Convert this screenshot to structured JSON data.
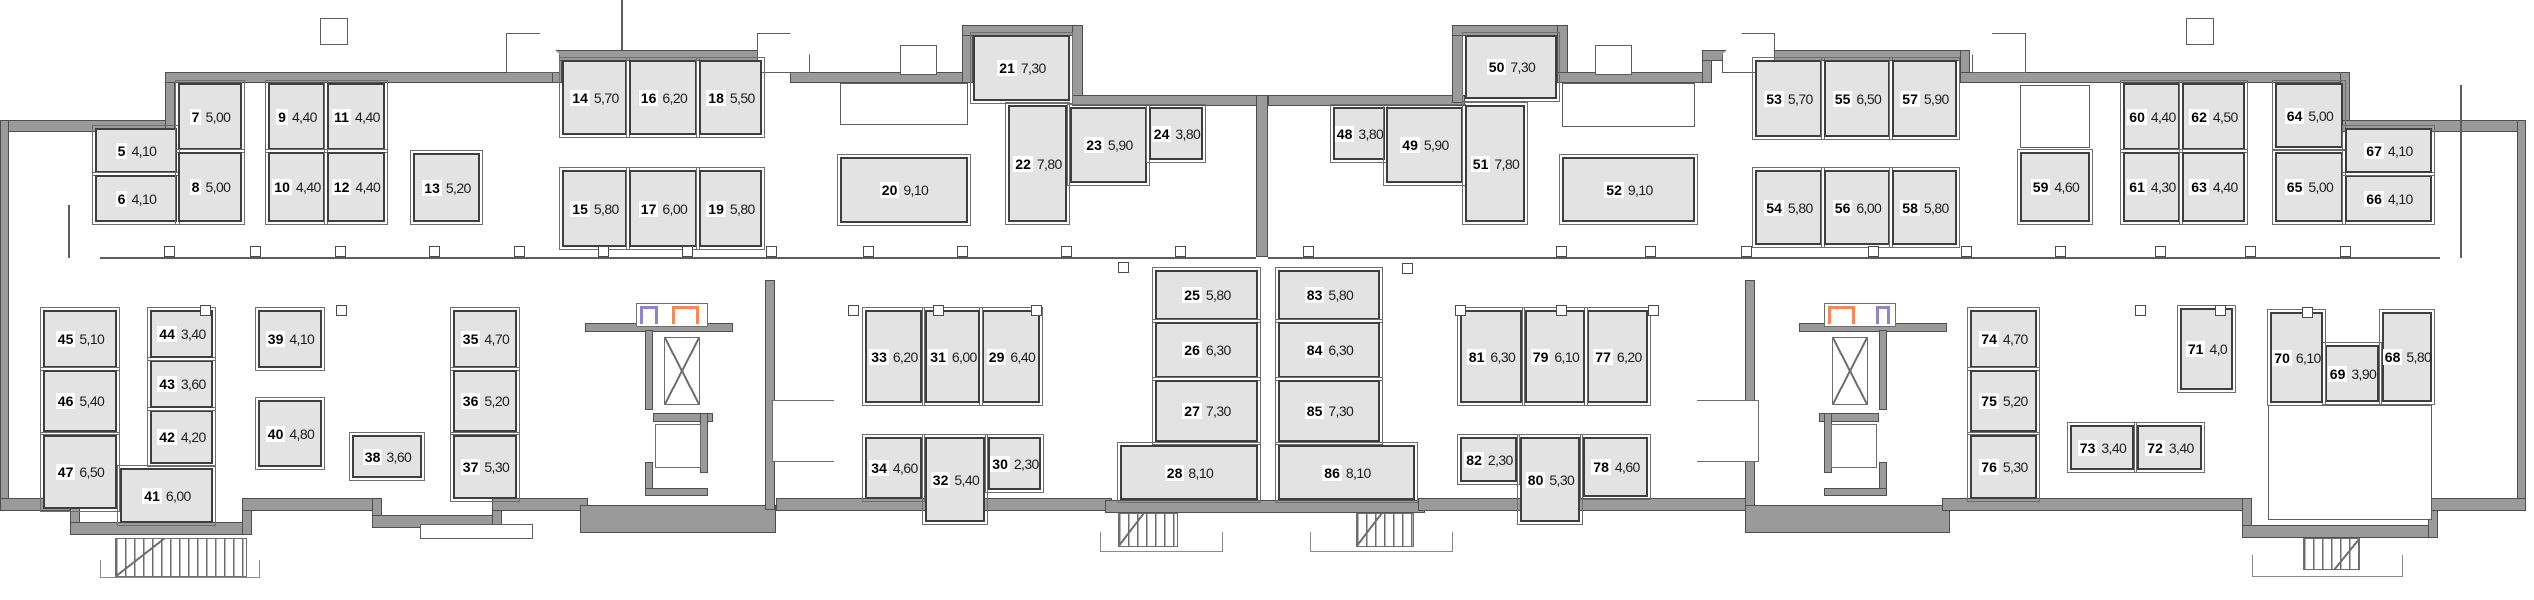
{
  "plan": {
    "canvas": {
      "w": 2534,
      "h": 600
    },
    "colors": {
      "wall_gray": "#9a9a9a",
      "wall_edge": "#4f4f4f",
      "room_fill": "#e3e3e3",
      "room_border": "#3e3e3e",
      "door_marker_purple": "#9185c6",
      "door_marker_orange": "#f08a5c",
      "background": "#ffffff"
    },
    "rooms": [
      {
        "n": "5",
        "a": "4,10",
        "x": 95,
        "y": 128,
        "w": 82,
        "h": 45
      },
      {
        "n": "6",
        "a": "4,10",
        "x": 95,
        "y": 175,
        "w": 82,
        "h": 47
      },
      {
        "n": "7",
        "a": "5,00",
        "x": 178,
        "y": 83,
        "w": 64,
        "h": 67
      },
      {
        "n": "8",
        "a": "5,00",
        "x": 178,
        "y": 152,
        "w": 64,
        "h": 70
      },
      {
        "n": "9",
        "a": "4,40",
        "x": 268,
        "y": 83,
        "w": 57,
        "h": 67
      },
      {
        "n": "10",
        "a": "4,40",
        "x": 268,
        "y": 152,
        "w": 57,
        "h": 70
      },
      {
        "n": "11",
        "a": "4,40",
        "x": 327,
        "y": 83,
        "w": 58,
        "h": 67
      },
      {
        "n": "12",
        "a": "4,40",
        "x": 327,
        "y": 152,
        "w": 58,
        "h": 70
      },
      {
        "n": "13",
        "a": "5,20",
        "x": 413,
        "y": 153,
        "w": 67,
        "h": 69
      },
      {
        "n": "14",
        "a": "5,70",
        "x": 562,
        "y": 60,
        "w": 65,
        "h": 75
      },
      {
        "n": "15",
        "a": "5,80",
        "x": 562,
        "y": 170,
        "w": 65,
        "h": 77
      },
      {
        "n": "16",
        "a": "6,20",
        "x": 629,
        "y": 60,
        "w": 68,
        "h": 75
      },
      {
        "n": "17",
        "a": "6,00",
        "x": 629,
        "y": 170,
        "w": 68,
        "h": 77
      },
      {
        "n": "18",
        "a": "5,50",
        "x": 699,
        "y": 60,
        "w": 63,
        "h": 75
      },
      {
        "n": "19",
        "a": "5,80",
        "x": 699,
        "y": 170,
        "w": 63,
        "h": 77
      },
      {
        "n": "20",
        "a": "9,10",
        "x": 840,
        "y": 157,
        "w": 128,
        "h": 66
      },
      {
        "n": "21",
        "a": "7,30",
        "x": 973,
        "y": 35,
        "w": 97,
        "h": 66
      },
      {
        "n": "22",
        "a": "7,80",
        "x": 1008,
        "y": 105,
        "w": 59,
        "h": 117
      },
      {
        "n": "23",
        "a": "5,90",
        "x": 1070,
        "y": 107,
        "w": 77,
        "h": 76
      },
      {
        "n": "24",
        "a": "3,80",
        "x": 1149,
        "y": 107,
        "w": 54,
        "h": 53
      },
      {
        "n": "25",
        "a": "5,80",
        "x": 1155,
        "y": 270,
        "w": 103,
        "h": 50
      },
      {
        "n": "26",
        "a": "6,30",
        "x": 1155,
        "y": 322,
        "w": 103,
        "h": 56
      },
      {
        "n": "27",
        "a": "7,30",
        "x": 1155,
        "y": 380,
        "w": 103,
        "h": 62
      },
      {
        "n": "28",
        "a": "8,10",
        "x": 1120,
        "y": 445,
        "w": 138,
        "h": 55
      },
      {
        "n": "29",
        "a": "6,40",
        "x": 982,
        "y": 310,
        "w": 58,
        "h": 93
      },
      {
        "n": "30",
        "a": "2,30",
        "x": 988,
        "y": 437,
        "w": 53,
        "h": 53
      },
      {
        "n": "31",
        "a": "6,00",
        "x": 925,
        "y": 310,
        "w": 55,
        "h": 93
      },
      {
        "n": "32",
        "a": "5,40",
        "x": 925,
        "y": 437,
        "w": 60,
        "h": 85
      },
      {
        "n": "33",
        "a": "6,20",
        "x": 865,
        "y": 310,
        "w": 57,
        "h": 93
      },
      {
        "n": "34",
        "a": "4,60",
        "x": 865,
        "y": 437,
        "w": 57,
        "h": 62
      },
      {
        "n": "35",
        "a": "4,70",
        "x": 453,
        "y": 310,
        "w": 64,
        "h": 58
      },
      {
        "n": "36",
        "a": "5,20",
        "x": 453,
        "y": 370,
        "w": 64,
        "h": 62
      },
      {
        "n": "37",
        "a": "5,30",
        "x": 453,
        "y": 435,
        "w": 64,
        "h": 64
      },
      {
        "n": "38",
        "a": "3,60",
        "x": 352,
        "y": 435,
        "w": 70,
        "h": 43
      },
      {
        "n": "39",
        "a": "4,10",
        "x": 258,
        "y": 310,
        "w": 64,
        "h": 58
      },
      {
        "n": "40",
        "a": "4,80",
        "x": 258,
        "y": 400,
        "w": 64,
        "h": 67
      },
      {
        "n": "41",
        "a": "6,00",
        "x": 120,
        "y": 468,
        "w": 93,
        "h": 55
      },
      {
        "n": "42",
        "a": "4,20",
        "x": 150,
        "y": 410,
        "w": 63,
        "h": 54
      },
      {
        "n": "43",
        "a": "3,60",
        "x": 150,
        "y": 360,
        "w": 63,
        "h": 48
      },
      {
        "n": "44",
        "a": "3,40",
        "x": 150,
        "y": 310,
        "w": 63,
        "h": 48
      },
      {
        "n": "45",
        "a": "5,10",
        "x": 43,
        "y": 310,
        "w": 74,
        "h": 58
      },
      {
        "n": "46",
        "a": "5,40",
        "x": 43,
        "y": 370,
        "w": 74,
        "h": 62
      },
      {
        "n": "47",
        "a": "6,50",
        "x": 43,
        "y": 435,
        "w": 74,
        "h": 74
      },
      {
        "n": "48",
        "a": "3,80",
        "x": 1333,
        "y": 107,
        "w": 52,
        "h": 53
      },
      {
        "n": "49",
        "a": "5,90",
        "x": 1386,
        "y": 107,
        "w": 77,
        "h": 76
      },
      {
        "n": "50",
        "a": "7,30",
        "x": 1465,
        "y": 35,
        "w": 92,
        "h": 64
      },
      {
        "n": "51",
        "a": "7,80",
        "x": 1465,
        "y": 105,
        "w": 60,
        "h": 117
      },
      {
        "n": "52",
        "a": "9,10",
        "x": 1562,
        "y": 157,
        "w": 133,
        "h": 65
      },
      {
        "n": "53",
        "a": "5,70",
        "x": 1755,
        "y": 60,
        "w": 67,
        "h": 77
      },
      {
        "n": "54",
        "a": "5,80",
        "x": 1755,
        "y": 170,
        "w": 67,
        "h": 75
      },
      {
        "n": "55",
        "a": "6,50",
        "x": 1824,
        "y": 60,
        "w": 66,
        "h": 77
      },
      {
        "n": "56",
        "a": "6,00",
        "x": 1824,
        "y": 170,
        "w": 66,
        "h": 75
      },
      {
        "n": "57",
        "a": "5,90",
        "x": 1892,
        "y": 60,
        "w": 65,
        "h": 77
      },
      {
        "n": "58",
        "a": "5,80",
        "x": 1892,
        "y": 170,
        "w": 65,
        "h": 75
      },
      {
        "n": "59",
        "a": "4,60",
        "x": 2020,
        "y": 152,
        "w": 70,
        "h": 70
      },
      {
        "n": "60",
        "a": "4,40",
        "x": 2123,
        "y": 83,
        "w": 57,
        "h": 67
      },
      {
        "n": "61",
        "a": "4,30",
        "x": 2123,
        "y": 152,
        "w": 57,
        "h": 70
      },
      {
        "n": "62",
        "a": "4,50",
        "x": 2182,
        "y": 83,
        "w": 63,
        "h": 67
      },
      {
        "n": "63",
        "a": "4,40",
        "x": 2182,
        "y": 152,
        "w": 63,
        "h": 70
      },
      {
        "n": "64",
        "a": "5,00",
        "x": 2275,
        "y": 83,
        "w": 68,
        "h": 65
      },
      {
        "n": "65",
        "a": "5,00",
        "x": 2275,
        "y": 152,
        "w": 68,
        "h": 70
      },
      {
        "n": "66",
        "a": "4,10",
        "x": 2345,
        "y": 175,
        "w": 87,
        "h": 47
      },
      {
        "n": "67",
        "a": "4,10",
        "x": 2345,
        "y": 128,
        "w": 87,
        "h": 45
      },
      {
        "n": "68",
        "a": "5,80",
        "x": 2382,
        "y": 312,
        "w": 50,
        "h": 90
      },
      {
        "n": "69",
        "a": "3,90",
        "x": 2325,
        "y": 345,
        "w": 54,
        "h": 57
      },
      {
        "n": "70",
        "a": "6,10",
        "x": 2270,
        "y": 312,
        "w": 53,
        "h": 91
      },
      {
        "n": "71",
        "a": "4,0",
        "x": 2180,
        "y": 308,
        "w": 53,
        "h": 82
      },
      {
        "n": "72",
        "a": "3,40",
        "x": 2137,
        "y": 425,
        "w": 65,
        "h": 45
      },
      {
        "n": "73",
        "a": "3,40",
        "x": 2070,
        "y": 425,
        "w": 64,
        "h": 45
      },
      {
        "n": "74",
        "a": "4,70",
        "x": 1970,
        "y": 310,
        "w": 67,
        "h": 58
      },
      {
        "n": "75",
        "a": "5,20",
        "x": 1970,
        "y": 370,
        "w": 67,
        "h": 62
      },
      {
        "n": "76",
        "a": "5,30",
        "x": 1970,
        "y": 435,
        "w": 67,
        "h": 64
      },
      {
        "n": "77",
        "a": "6,20",
        "x": 1587,
        "y": 310,
        "w": 61,
        "h": 93
      },
      {
        "n": "78",
        "a": "4,60",
        "x": 1583,
        "y": 437,
        "w": 65,
        "h": 60
      },
      {
        "n": "79",
        "a": "6,10",
        "x": 1525,
        "y": 310,
        "w": 60,
        "h": 93
      },
      {
        "n": "80",
        "a": "5,30",
        "x": 1520,
        "y": 437,
        "w": 60,
        "h": 85
      },
      {
        "n": "81",
        "a": "6,30",
        "x": 1460,
        "y": 310,
        "w": 62,
        "h": 93
      },
      {
        "n": "82",
        "a": "2,30",
        "x": 1460,
        "y": 437,
        "w": 57,
        "h": 45
      },
      {
        "n": "83",
        "a": "5,80",
        "x": 1278,
        "y": 270,
        "w": 102,
        "h": 50
      },
      {
        "n": "84",
        "a": "6,30",
        "x": 1278,
        "y": 322,
        "w": 102,
        "h": 56
      },
      {
        "n": "85",
        "a": "7,30",
        "x": 1278,
        "y": 380,
        "w": 102,
        "h": 62
      },
      {
        "n": "86",
        "a": "8,10",
        "x": 1278,
        "y": 445,
        "w": 137,
        "h": 55
      }
    ]
  }
}
